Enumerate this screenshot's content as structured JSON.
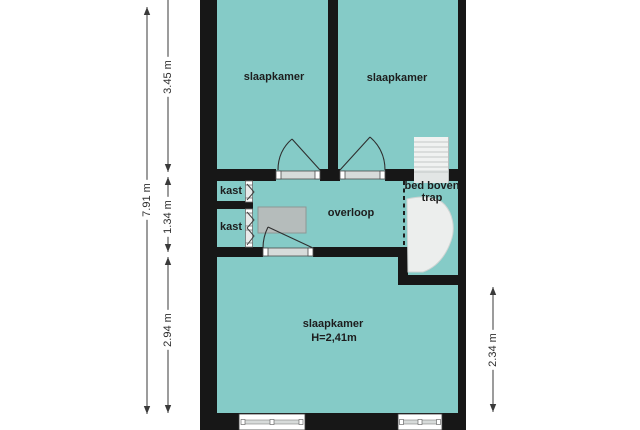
{
  "title": "first floor plan",
  "colors": {
    "room_fill": "#85cbc7",
    "wall": "#171717",
    "furniture_fill": "#b5bcbb",
    "stairs_fill": "#f0f2f1",
    "dimension_line": "#3a3a3a"
  },
  "rooms": {
    "bedroom_top_left": {
      "label": "slaapkamer"
    },
    "bedroom_top_right": {
      "label": "slaapkamer"
    },
    "closet_top": {
      "label": "kast"
    },
    "closet_bottom": {
      "label": "kast"
    },
    "landing": {
      "label": "overloop"
    },
    "bed_above_stairs": {
      "label": "bed boven\ntrap"
    },
    "bedroom_bottom": {
      "label": "slaapkamer",
      "height_label": "H=2,41m"
    }
  },
  "dimensions": {
    "total_height": "7.91 m",
    "upper_section": "3.45 m",
    "middle_section": "1.34 m",
    "lower_section": "2.94 m",
    "right_section": "2.34 m"
  }
}
